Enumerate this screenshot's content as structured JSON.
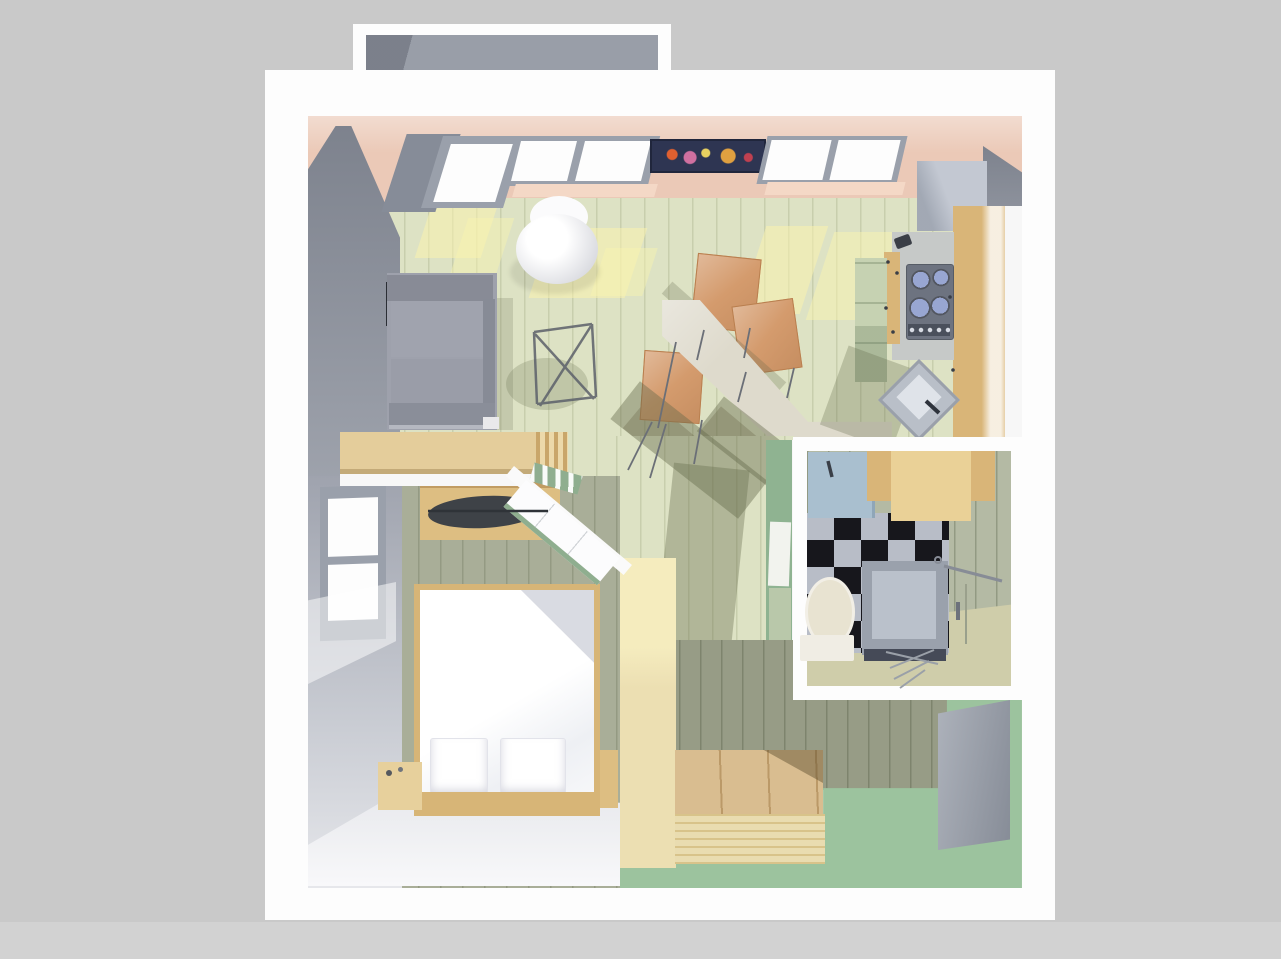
{
  "scene": {
    "view": "top-down-3d-floorplan",
    "rooms": [
      {
        "name": "balcony",
        "items": [
          "balcony-floor"
        ]
      },
      {
        "name": "living-room",
        "items": [
          "sofa",
          "wall-tv",
          "pod-armchair",
          "folding-stool",
          "dining-counter",
          "dining-chair",
          "dining-chair",
          "dining-chair",
          "wall-picture",
          "window",
          "window",
          "balcony-door"
        ]
      },
      {
        "name": "kitchen",
        "items": [
          "refrigerator",
          "cabinet-run",
          "cooktop",
          "kitchen-sink",
          "tall-cabinet",
          "kettle"
        ]
      },
      {
        "name": "bedroom",
        "items": [
          "double-bed",
          "pillow",
          "pillow",
          "wardrobe",
          "nightstand",
          "window",
          "open-door",
          "sideboard"
        ]
      },
      {
        "name": "bathroom",
        "items": [
          "washbasin",
          "bathroom-cabinet",
          "checkerboard-floor",
          "toilet",
          "shower-cabin",
          "towel-bar",
          "drying-rack"
        ]
      },
      {
        "name": "hallway",
        "items": [
          "wooden-platform",
          "front-door",
          "corridor-floor"
        ]
      }
    ]
  },
  "colors": {
    "background": "#c9c9c9",
    "backdrop_strip": "#d2d2d2",
    "wall_white": "#fdfdfd",
    "white_band": "#f7f7f7",
    "balcony_floor": "#999ea8",
    "balcony_door_gray": "#868c98",
    "ceiling_pink": "#ebc9b7",
    "sill_pink": "#f4d8c6",
    "left_wall_gray": "#9196a1",
    "living_floor": "#dde2c4",
    "sunlight": "#f9f3af",
    "corridor_wood": "#ecdfb2",
    "hall_floor_green": "#9cc39e",
    "green_wall": "#8fb391",
    "green_panel_light": "#b9c8aa",
    "hall_shadow_floor": "#979c86",
    "platform_wood": "#d9bd90",
    "platform_front": "#e9dcb0",
    "front_door": "#9ba1ac",
    "bathroom_wall": "#b4baa4",
    "bathroom_floor": "#cfcdaa",
    "checker_light": "#b8bdc7",
    "checker_dark": "#17171c",
    "basin_blue": "#a9bfcf",
    "cabinet_wood": "#d9b578",
    "cabinet_wood_light": "#ead197",
    "shower_gray": "#9aa1ac",
    "shower_inner": "#bac1cb",
    "shower_base": "#454a57",
    "toilet_cream": "#e8e3d1",
    "toilet_tank": "#f0ede4",
    "stove_dark": "#6d7380",
    "knob_strip": "#4a505c",
    "burner_blue": "#8b9bcc",
    "counter_gray": "#c6c9c8",
    "green_cabinet": "#c6d2b2",
    "dining_counter": "#dedacc",
    "chair_orange": "#d49b6d",
    "sofa_gray": "#9ea1ac",
    "sofa_back": "#888b96",
    "sofa_front": "#8a8e99",
    "bed_wood": "#d7b577",
    "duvet_white": "#ffffff",
    "bedroom_wall": "#a9ae98",
    "door_trim_green": "#8fae8f",
    "picture_navy": "#2e3552",
    "window_frame": "#9aa0ab",
    "window_pane": "#fdfdfd",
    "fridge_gray": "#c3c8d2",
    "wardrobe_wood": "#ddbe82",
    "clothes_dark": "#3e4247",
    "tv_black": "#2b2e35",
    "kettle_dark": "#3a3e46",
    "nightstand_wood": "#e7d09c",
    "sideboard_wood": "#e4cd9b",
    "poster_white": "#f2f3ee"
  }
}
